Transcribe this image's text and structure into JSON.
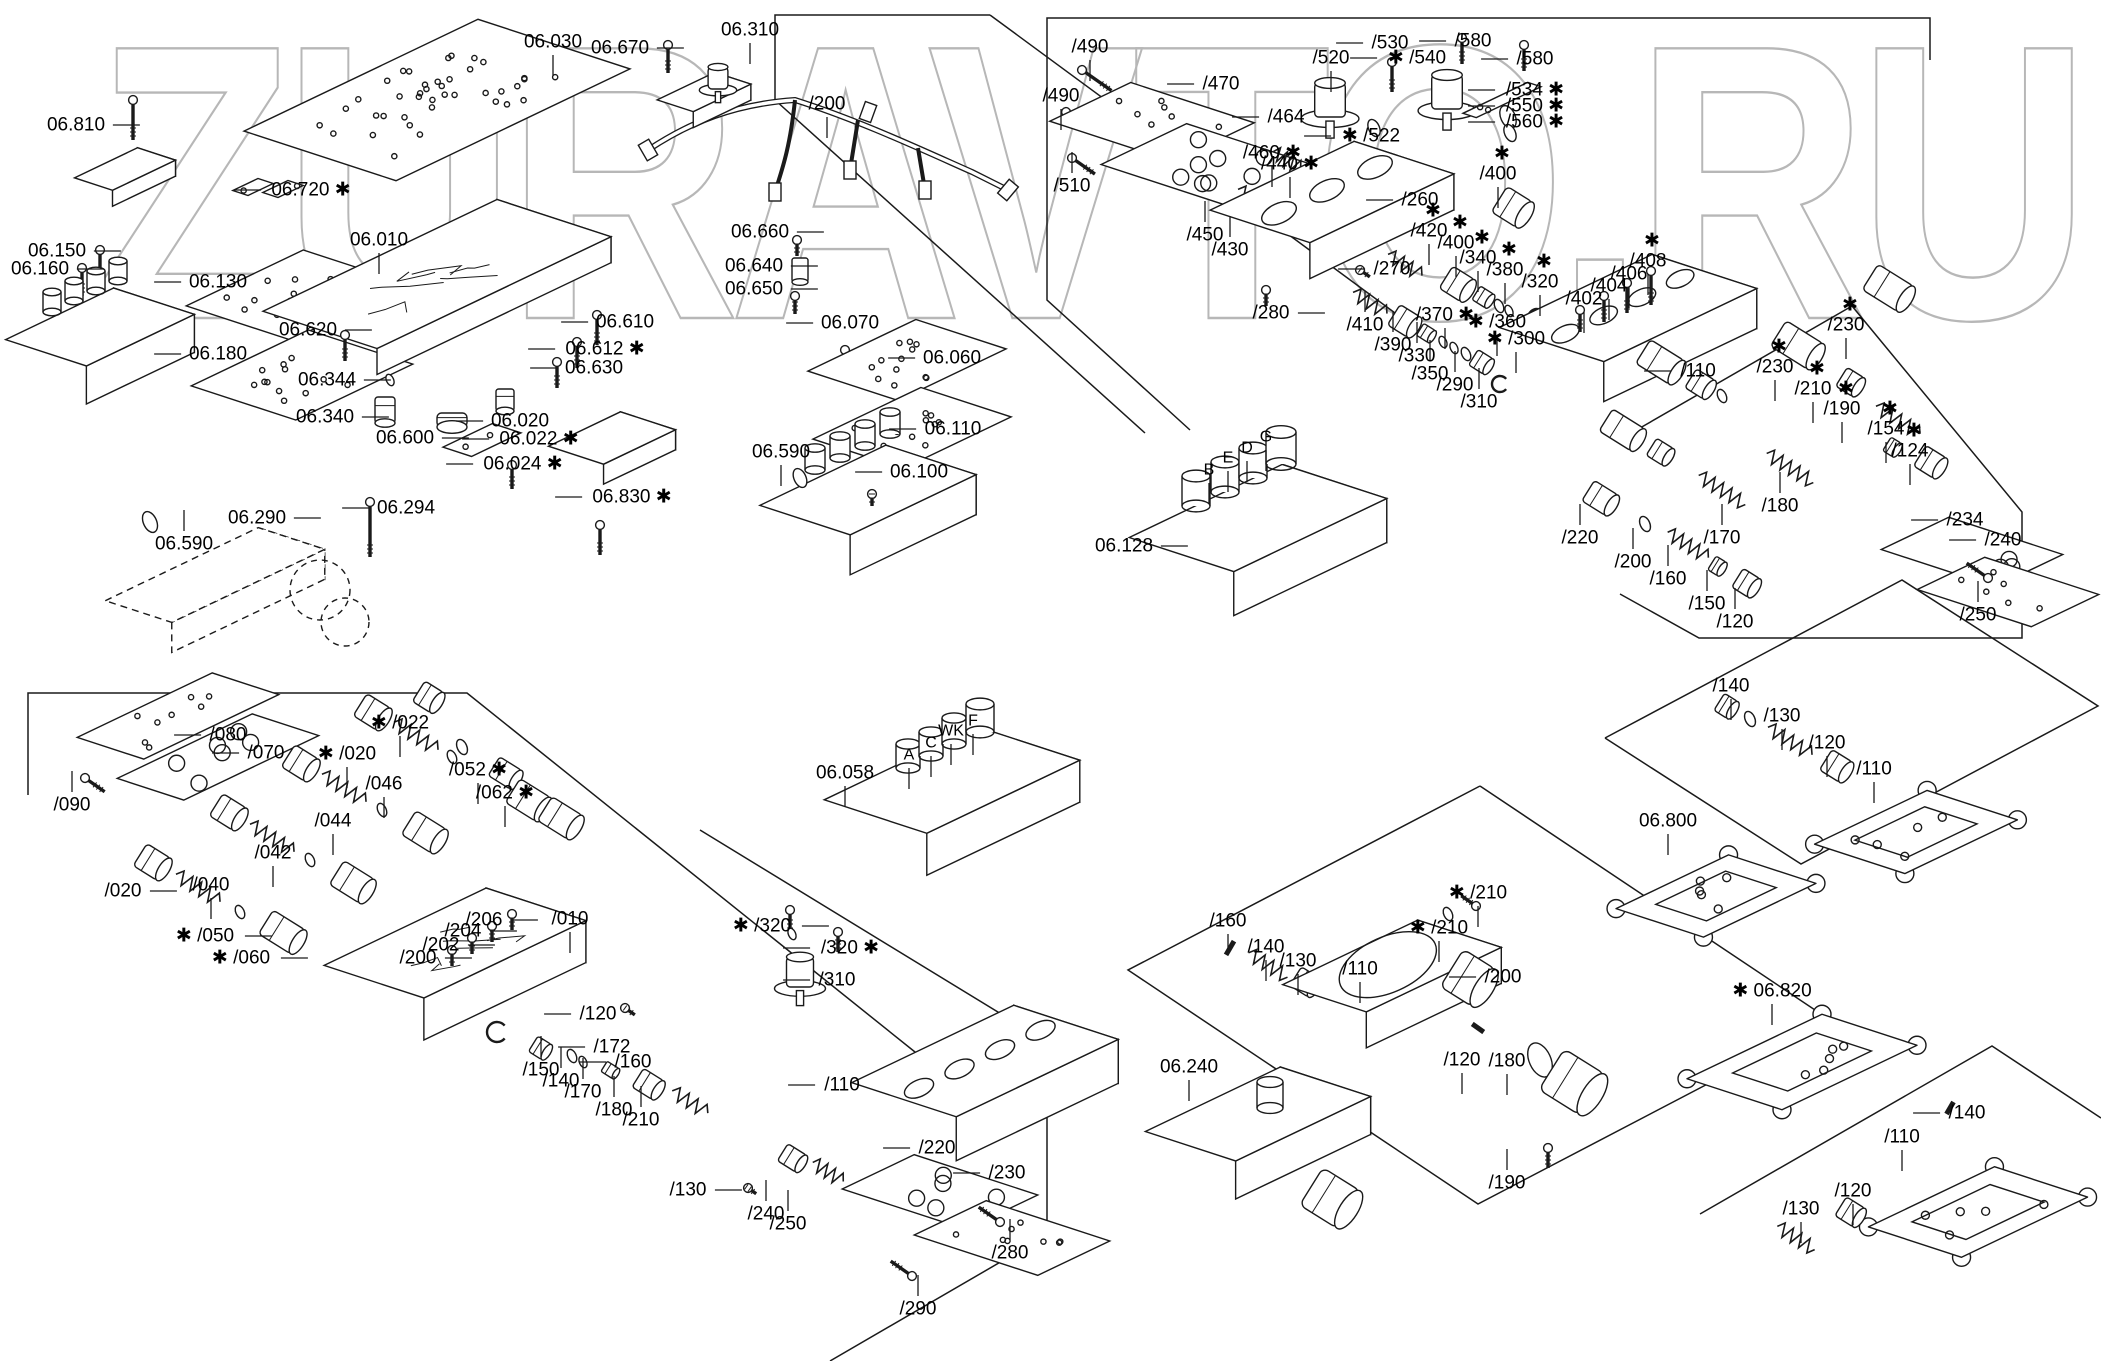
{
  "watermark": "ZURAVTO.RU",
  "sections": [
    {
      "name": "top-left-plates",
      "labels": [
        {
          "t": "06.810",
          "x": 76,
          "y": 125,
          "ld": "r"
        },
        {
          "t": "06.720",
          "x": 311,
          "y": 190,
          "s": "a",
          "ld": "l"
        },
        {
          "t": "06.150",
          "x": 57,
          "y": 251,
          "ld": "r"
        },
        {
          "t": "06.160",
          "x": 40,
          "y": 269,
          "ld": "r"
        },
        {
          "t": "06.130",
          "x": 218,
          "y": 282,
          "ld": "l"
        },
        {
          "t": "06.180",
          "x": 218,
          "y": 354,
          "ld": "l"
        },
        {
          "t": "06.590",
          "x": 184,
          "y": 544,
          "ld": "u"
        },
        {
          "t": "06.290",
          "x": 257,
          "y": 518,
          "ld": "r"
        },
        {
          "t": "06.294",
          "x": 406,
          "y": 508,
          "ld": "l"
        }
      ]
    },
    {
      "name": "main-valve-body",
      "labels": [
        {
          "t": "06.030",
          "x": 553,
          "y": 42,
          "ld": "d"
        },
        {
          "t": "06.670",
          "x": 620,
          "y": 48,
          "ld": "r"
        },
        {
          "t": "06.310",
          "x": 750,
          "y": 30,
          "ld": "d"
        },
        {
          "t": "/200",
          "x": 827,
          "y": 104,
          "ld": "d"
        },
        {
          "t": "06.660",
          "x": 760,
          "y": 232,
          "ld": "r"
        },
        {
          "t": "06.640",
          "x": 754,
          "y": 266,
          "ld": "r"
        },
        {
          "t": "06.650",
          "x": 754,
          "y": 289,
          "ld": "r"
        },
        {
          "t": "06.010",
          "x": 379,
          "y": 240,
          "ld": "d"
        },
        {
          "t": "06.620",
          "x": 308,
          "y": 330,
          "ld": "r"
        },
        {
          "t": "06.610",
          "x": 625,
          "y": 322,
          "ld": "l"
        },
        {
          "t": "06.612",
          "x": 605,
          "y": 349,
          "s": "a",
          "ld": "l"
        },
        {
          "t": "06.630",
          "x": 594,
          "y": 368,
          "ld": "l"
        },
        {
          "t": "06.344",
          "x": 327,
          "y": 380,
          "ld": "r"
        },
        {
          "t": "06.340",
          "x": 325,
          "y": 417,
          "ld": "r"
        },
        {
          "t": "06.600",
          "x": 405,
          "y": 438,
          "ld": "r"
        },
        {
          "t": "06.020",
          "x": 520,
          "y": 421,
          "ld": "l"
        },
        {
          "t": "06.022",
          "x": 539,
          "y": 439,
          "s": "a",
          "ld": "l"
        },
        {
          "t": "06.024",
          "x": 523,
          "y": 464,
          "s": "a",
          "ld": "l"
        },
        {
          "t": "06.830",
          "x": 632,
          "y": 497,
          "s": "a",
          "ld": "l"
        },
        {
          "t": "06.070",
          "x": 850,
          "y": 323,
          "ld": "l"
        },
        {
          "t": "06.060",
          "x": 952,
          "y": 358,
          "ld": "l"
        },
        {
          "t": "06.110",
          "x": 953,
          "y": 429,
          "ld": "l"
        },
        {
          "t": "06.100",
          "x": 919,
          "y": 472,
          "ld": "l"
        },
        {
          "t": "06.590",
          "x": 781,
          "y": 452,
          "ld": "d"
        }
      ]
    },
    {
      "name": "top-right-valves",
      "labels": [
        {
          "t": "/490",
          "x": 1090,
          "y": 47,
          "ld": "d"
        },
        {
          "t": "/490",
          "x": 1061,
          "y": 96,
          "ld": "d"
        },
        {
          "t": "/510",
          "x": 1072,
          "y": 186,
          "ld": "u"
        },
        {
          "t": "/470",
          "x": 1221,
          "y": 84,
          "ld": "l"
        },
        {
          "t": "/464",
          "x": 1286,
          "y": 117,
          "ld": "l"
        },
        {
          "t": "/460",
          "x": 1272,
          "y": 153,
          "s": "a",
          "ld": "d"
        },
        {
          "t": "/440",
          "x": 1290,
          "y": 164,
          "s": "a",
          "ld": "d"
        },
        {
          "t": "/450",
          "x": 1205,
          "y": 235,
          "ld": "u"
        },
        {
          "t": "/430",
          "x": 1230,
          "y": 250,
          "ld": "u"
        },
        {
          "t": "/520",
          "x": 1331,
          "y": 58,
          "ld": "d"
        },
        {
          "t": "/530",
          "x": 1390,
          "y": 43,
          "ld": "l"
        },
        {
          "t": "/540",
          "x": 1417,
          "y": 58,
          "s": "b",
          "ld": "l"
        },
        {
          "t": "/580",
          "x": 1473,
          "y": 41,
          "ld": "l"
        },
        {
          "t": "/580",
          "x": 1535,
          "y": 59,
          "ld": "l"
        },
        {
          "t": "/534",
          "x": 1535,
          "y": 90,
          "s": "a",
          "ld": "l"
        },
        {
          "t": "/550",
          "x": 1535,
          "y": 106,
          "s": "a",
          "ld": "l"
        },
        {
          "t": "/560",
          "x": 1535,
          "y": 122,
          "s": "a",
          "ld": "l"
        },
        {
          "t": "/522",
          "x": 1371,
          "y": 136,
          "s": "b",
          "ld": "l"
        },
        {
          "t": "/260",
          "x": 1420,
          "y": 200,
          "ld": "l"
        },
        {
          "t": "/270",
          "x": 1392,
          "y": 269,
          "ld": "l"
        },
        {
          "t": "/280",
          "x": 1271,
          "y": 313,
          "ld": "r"
        },
        {
          "t": "/420",
          "x": 1429,
          "y": 231,
          "s": "ab",
          "ld": "d"
        },
        {
          "t": "/400",
          "x": 1498,
          "y": 174,
          "s": "ab",
          "ld": "d"
        },
        {
          "t": "/400",
          "x": 1456,
          "y": 243,
          "s": "ab",
          "ld": "d"
        },
        {
          "t": "/340",
          "x": 1478,
          "y": 258,
          "s": "ab",
          "ld": "d"
        },
        {
          "t": "/380",
          "x": 1505,
          "y": 270,
          "s": "ab",
          "ld": "d"
        },
        {
          "t": "/320",
          "x": 1540,
          "y": 282,
          "s": "ab",
          "ld": "d"
        },
        {
          "t": "/410",
          "x": 1365,
          "y": 325,
          "ld": "u"
        },
        {
          "t": "/390",
          "x": 1393,
          "y": 345,
          "ld": "u"
        },
        {
          "t": "/330",
          "x": 1417,
          "y": 356,
          "ld": "u"
        },
        {
          "t": "/350",
          "x": 1430,
          "y": 374,
          "ld": "u"
        },
        {
          "t": "/370",
          "x": 1445,
          "y": 315,
          "s": "a",
          "ld": "d"
        },
        {
          "t": "/360",
          "x": 1497,
          "y": 322,
          "s": "b",
          "ld": "d"
        },
        {
          "t": "/300",
          "x": 1516,
          "y": 339,
          "s": "b",
          "ld": "d"
        },
        {
          "t": "/290",
          "x": 1455,
          "y": 385,
          "ld": "u"
        },
        {
          "t": "/310",
          "x": 1479,
          "y": 402,
          "ld": "u"
        },
        {
          "t": "/402",
          "x": 1584,
          "y": 299,
          "ld": "d"
        },
        {
          "t": "/404",
          "x": 1609,
          "y": 286,
          "ld": "d"
        },
        {
          "t": "/406",
          "x": 1629,
          "y": 274,
          "ld": "d"
        },
        {
          "t": "/408",
          "x": 1648,
          "y": 261,
          "s": "ab",
          "ld": "d"
        },
        {
          "t": "/110",
          "x": 1698,
          "y": 371,
          "ld": "l"
        }
      ]
    },
    {
      "name": "solenoid-block-06128",
      "labels": [
        {
          "t": "06.128",
          "x": 1124,
          "y": 546,
          "ld": "r"
        },
        {
          "t": "B",
          "x": 1209,
          "y": 470,
          "ld": "d"
        },
        {
          "t": "E",
          "x": 1228,
          "y": 458,
          "ld": "d"
        },
        {
          "t": "D",
          "x": 1247,
          "y": 448,
          "ld": "d"
        },
        {
          "t": "G",
          "x": 1266,
          "y": 437,
          "ld": "d"
        }
      ]
    },
    {
      "name": "right-middle-spools",
      "labels": [
        {
          "t": "/230",
          "x": 1846,
          "y": 325,
          "s": "ab",
          "ld": "d"
        },
        {
          "t": "/230",
          "x": 1775,
          "y": 367,
          "s": "ab",
          "ld": "d"
        },
        {
          "t": "/210",
          "x": 1813,
          "y": 389,
          "s": "ab",
          "ld": "d"
        },
        {
          "t": "/190",
          "x": 1842,
          "y": 409,
          "s": "ab",
          "ld": "d"
        },
        {
          "t": "/154",
          "x": 1886,
          "y": 429,
          "s": "ab",
          "ld": "d"
        },
        {
          "t": "/124",
          "x": 1910,
          "y": 451,
          "s": "ab",
          "ld": "d"
        },
        {
          "t": "/180",
          "x": 1780,
          "y": 506,
          "ld": "u"
        },
        {
          "t": "/170",
          "x": 1722,
          "y": 538,
          "ld": "u"
        },
        {
          "t": "/160",
          "x": 1668,
          "y": 579,
          "ld": "u"
        },
        {
          "t": "/200",
          "x": 1633,
          "y": 562,
          "ld": "u"
        },
        {
          "t": "/220",
          "x": 1580,
          "y": 538,
          "ld": "u"
        },
        {
          "t": "/150",
          "x": 1707,
          "y": 604,
          "ld": "u"
        },
        {
          "t": "/120",
          "x": 1735,
          "y": 622,
          "ld": "u"
        },
        {
          "t": "/234",
          "x": 1965,
          "y": 520,
          "ld": "l"
        },
        {
          "t": "/240",
          "x": 2003,
          "y": 540,
          "ld": "l"
        },
        {
          "t": "/250",
          "x": 1978,
          "y": 615,
          "ld": "u"
        }
      ]
    },
    {
      "name": "bottom-left-spools",
      "labels": [
        {
          "t": "/090",
          "x": 72,
          "y": 805,
          "ld": "u"
        },
        {
          "t": "/080",
          "x": 228,
          "y": 735,
          "ld": "l"
        },
        {
          "t": "/070",
          "x": 266,
          "y": 753,
          "ld": "l"
        },
        {
          "t": "/020",
          "x": 347,
          "y": 754,
          "s": "b",
          "ld": "d"
        },
        {
          "t": "/022",
          "x": 400,
          "y": 723,
          "s": "b",
          "ld": "d"
        },
        {
          "t": "/046",
          "x": 384,
          "y": 784,
          "ld": "d"
        },
        {
          "t": "/052",
          "x": 478,
          "y": 770,
          "s": "a",
          "ld": "d"
        },
        {
          "t": "/062",
          "x": 505,
          "y": 793,
          "s": "a",
          "ld": "d"
        },
        {
          "t": "/044",
          "x": 333,
          "y": 821,
          "ld": "d"
        },
        {
          "t": "/042",
          "x": 273,
          "y": 853,
          "ld": "d"
        },
        {
          "t": "/040",
          "x": 211,
          "y": 885,
          "ld": "d"
        },
        {
          "t": "/020",
          "x": 123,
          "y": 891,
          "ld": "r"
        },
        {
          "t": "/050",
          "x": 205,
          "y": 936,
          "s": "b",
          "ld": "r"
        },
        {
          "t": "/060",
          "x": 241,
          "y": 958,
          "s": "b",
          "ld": "r"
        },
        {
          "t": "/206",
          "x": 484,
          "y": 920,
          "ld": "r"
        },
        {
          "t": "/204",
          "x": 463,
          "y": 931,
          "ld": "r"
        },
        {
          "t": "/202",
          "x": 441,
          "y": 945,
          "ld": "r"
        },
        {
          "t": "/200",
          "x": 418,
          "y": 958,
          "ld": "r"
        },
        {
          "t": "/010",
          "x": 570,
          "y": 919,
          "ld": "d"
        },
        {
          "t": "/120",
          "x": 598,
          "y": 1014,
          "ld": "l"
        },
        {
          "t": "/150",
          "x": 541,
          "y": 1070,
          "ld": "u"
        },
        {
          "t": "/140",
          "x": 561,
          "y": 1081,
          "ld": "u"
        },
        {
          "t": "/170",
          "x": 583,
          "y": 1092,
          "ld": "u"
        },
        {
          "t": "/172",
          "x": 612,
          "y": 1047,
          "ld": "l"
        },
        {
          "t": "/160",
          "x": 633,
          "y": 1062,
          "ld": "l"
        },
        {
          "t": "/180",
          "x": 614,
          "y": 1110,
          "ld": "u"
        },
        {
          "t": "/210",
          "x": 641,
          "y": 1120,
          "ld": "u"
        },
        {
          "t": "/320",
          "x": 762,
          "y": 926,
          "s": "b",
          "ld": "r"
        },
        {
          "t": "/320",
          "x": 850,
          "y": 948,
          "s": "a",
          "ld": "l"
        },
        {
          "t": "/310",
          "x": 837,
          "y": 980,
          "ld": "l"
        },
        {
          "t": "/110",
          "x": 842,
          "y": 1085,
          "ld": "l"
        },
        {
          "t": "/130",
          "x": 688,
          "y": 1190,
          "ld": "r"
        },
        {
          "t": "/220",
          "x": 937,
          "y": 1148,
          "ld": "l"
        },
        {
          "t": "/230",
          "x": 1007,
          "y": 1173,
          "ld": "l"
        },
        {
          "t": "/240",
          "x": 766,
          "y": 1214,
          "ld": "u"
        },
        {
          "t": "/250",
          "x": 788,
          "y": 1224,
          "ld": "u"
        },
        {
          "t": "/280",
          "x": 1010,
          "y": 1253,
          "ld": "u"
        },
        {
          "t": "/290",
          "x": 918,
          "y": 1309,
          "ld": "u"
        },
        {
          "t": "06.058",
          "x": 845,
          "y": 773,
          "ld": "d"
        },
        {
          "t": "A",
          "x": 909,
          "y": 755,
          "ld": "d"
        },
        {
          "t": "C",
          "x": 931,
          "y": 743,
          "ld": "d"
        },
        {
          "t": "WK",
          "x": 951,
          "y": 731,
          "ld": "d"
        },
        {
          "t": "F",
          "x": 973,
          "y": 721,
          "ld": "d"
        }
      ]
    },
    {
      "name": "bottom-middle-solenoid-valves",
      "labels": [
        {
          "t": "/160",
          "x": 1228,
          "y": 921,
          "ld": "d"
        },
        {
          "t": "/140",
          "x": 1266,
          "y": 947,
          "ld": "d"
        },
        {
          "t": "/130",
          "x": 1298,
          "y": 961,
          "ld": "d"
        },
        {
          "t": "/110",
          "x": 1360,
          "y": 969,
          "ld": "d"
        },
        {
          "t": "/210",
          "x": 1478,
          "y": 893,
          "s": "b",
          "ld": "d"
        },
        {
          "t": "/210",
          "x": 1439,
          "y": 928,
          "s": "b",
          "ld": "d"
        },
        {
          "t": "/200",
          "x": 1503,
          "y": 977,
          "ld": "l"
        },
        {
          "t": "06.240",
          "x": 1189,
          "y": 1067,
          "ld": "d"
        },
        {
          "t": "/120",
          "x": 1462,
          "y": 1060,
          "ld": "d"
        },
        {
          "t": "/180",
          "x": 1507,
          "y": 1061,
          "ld": "d"
        },
        {
          "t": "/190",
          "x": 1507,
          "y": 1183,
          "ld": "u"
        }
      ]
    },
    {
      "name": "right-covers",
      "labels": [
        {
          "t": "/140",
          "x": 1731,
          "y": 686,
          "ld": "d"
        },
        {
          "t": "/130",
          "x": 1782,
          "y": 716,
          "ld": "d"
        },
        {
          "t": "/120",
          "x": 1827,
          "y": 743,
          "ld": "d"
        },
        {
          "t": "/110",
          "x": 1874,
          "y": 769,
          "ld": "d"
        },
        {
          "t": "06.800",
          "x": 1668,
          "y": 821,
          "ld": "d"
        },
        {
          "t": "06.820",
          "x": 1772,
          "y": 991,
          "s": "b",
          "ld": "d"
        }
      ]
    },
    {
      "name": "bottom-right-covers",
      "labels": [
        {
          "t": "/140",
          "x": 1967,
          "y": 1113,
          "ld": "l"
        },
        {
          "t": "/110",
          "x": 1902,
          "y": 1137,
          "ld": "d"
        },
        {
          "t": "/120",
          "x": 1853,
          "y": 1191,
          "ld": "d"
        },
        {
          "t": "/130",
          "x": 1801,
          "y": 1209,
          "ld": "d"
        }
      ]
    }
  ]
}
